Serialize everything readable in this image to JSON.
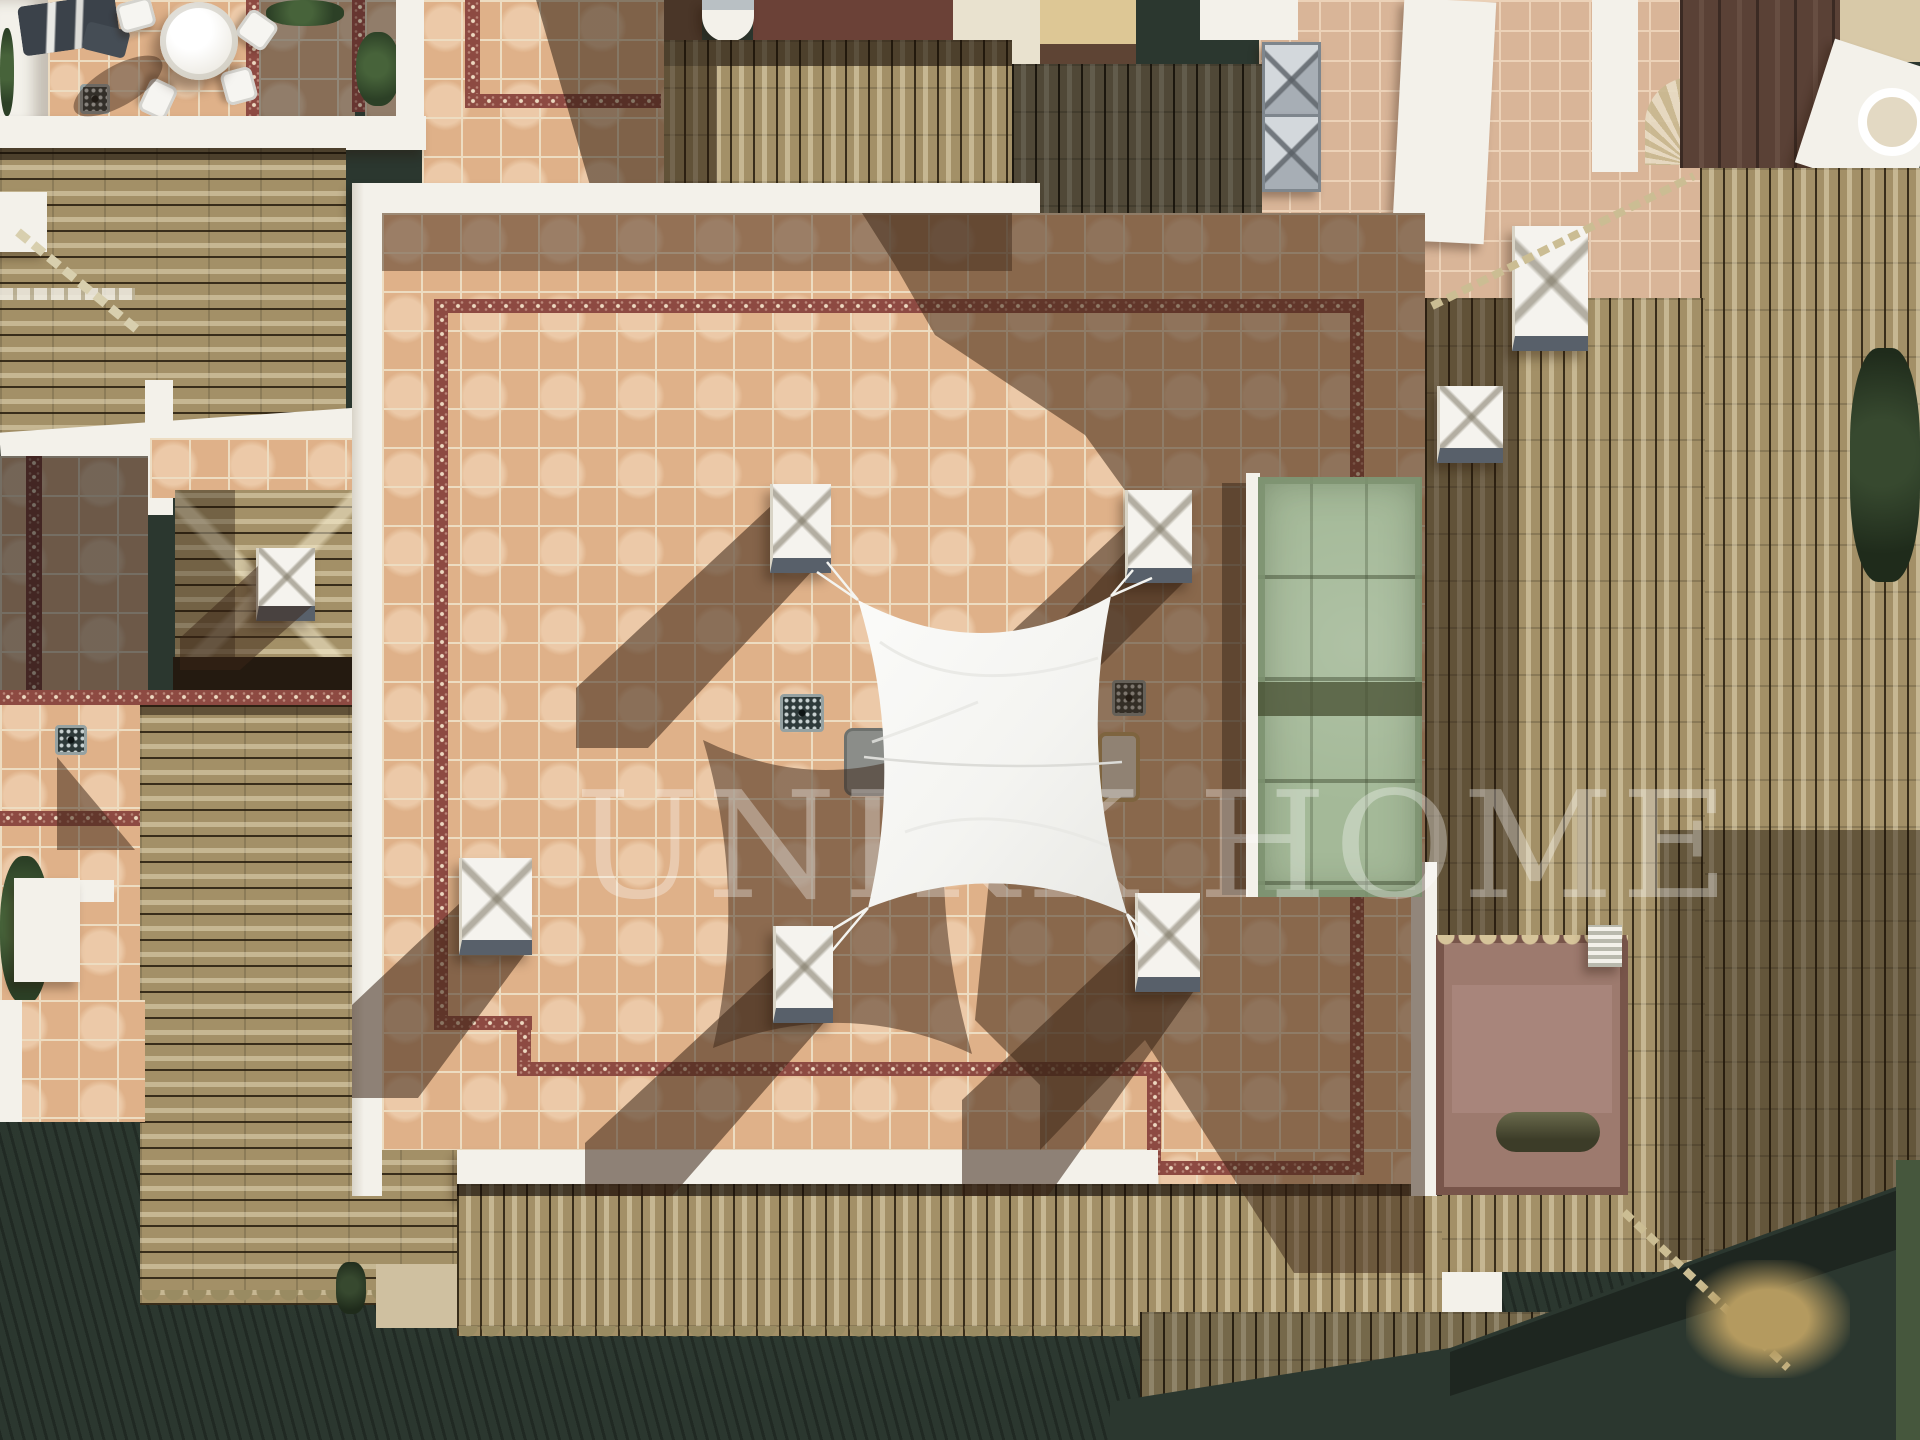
{
  "scene": {
    "description": "Aerial top-down drone photograph of a Mediterranean penthouse roof terrace with a white shade sail stretched between four white chimney pillars, terracotta floor tiles with maroon decorative tile borders, a sage-green skylight box, white parapet walls, Spanish barrel-tile roofs on all sides and dark garden ground along the bottom; hard midday sun casts long shadows toward the lower left",
    "watermark": {
      "text": "UNIKK HOME"
    }
  },
  "palette": {
    "tile": "#dfb189",
    "grout": "#eddcc1",
    "border": "#8d4a42",
    "roof": "#a39067",
    "roof_hi": "#c9ba90",
    "roof_dk": "#5e5138",
    "wall": "#f3f1ea",
    "shadow": "#3a2416",
    "sail": "#f6f6f3",
    "green_box": "#a4b998",
    "pink_tile": "#d9b598",
    "cream_wall": "#ddc795",
    "maroon_roof": "#6b4137",
    "ground": "#2b372f",
    "dry_grass": "#b49a5f",
    "skylight": "#c3c9cd"
  },
  "objects": [
    "white shade sail",
    "sail tie ropes",
    "chimney pillar x5",
    "patio table and chairs",
    "folded parasol",
    "floor drains",
    "sun loungers",
    "green skylight box",
    "metal pyramid skylights",
    "decorative maroon tile border",
    "barrel tile roofs",
    "white parapet walls",
    "dry grass patch",
    "garden ground"
  ]
}
